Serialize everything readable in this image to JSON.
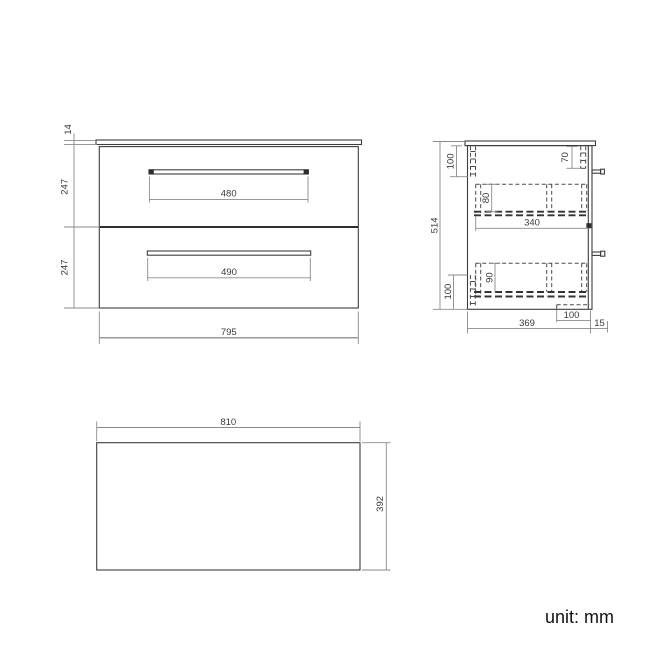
{
  "unit_label": "unit: mm",
  "views": {
    "front": {
      "countertop_thickness": "14",
      "top_drawer_height": "247",
      "bottom_drawer_height": "247",
      "top_handle_width": "480",
      "bottom_handle_width": "490",
      "cabinet_width": "795"
    },
    "side": {
      "total_height": "514",
      "top_rail_offset": "100",
      "back_bracket_height": "70",
      "top_drawer_side_height": "80",
      "drawer_inner_depth": "340",
      "bottom_drawer_side_height": "90",
      "bottom_rail_offset": "100",
      "base_recess_width": "100",
      "cabinet_depth": "369",
      "wall_gap": "15"
    },
    "top": {
      "countertop_width": "810",
      "countertop_depth": "392"
    }
  }
}
